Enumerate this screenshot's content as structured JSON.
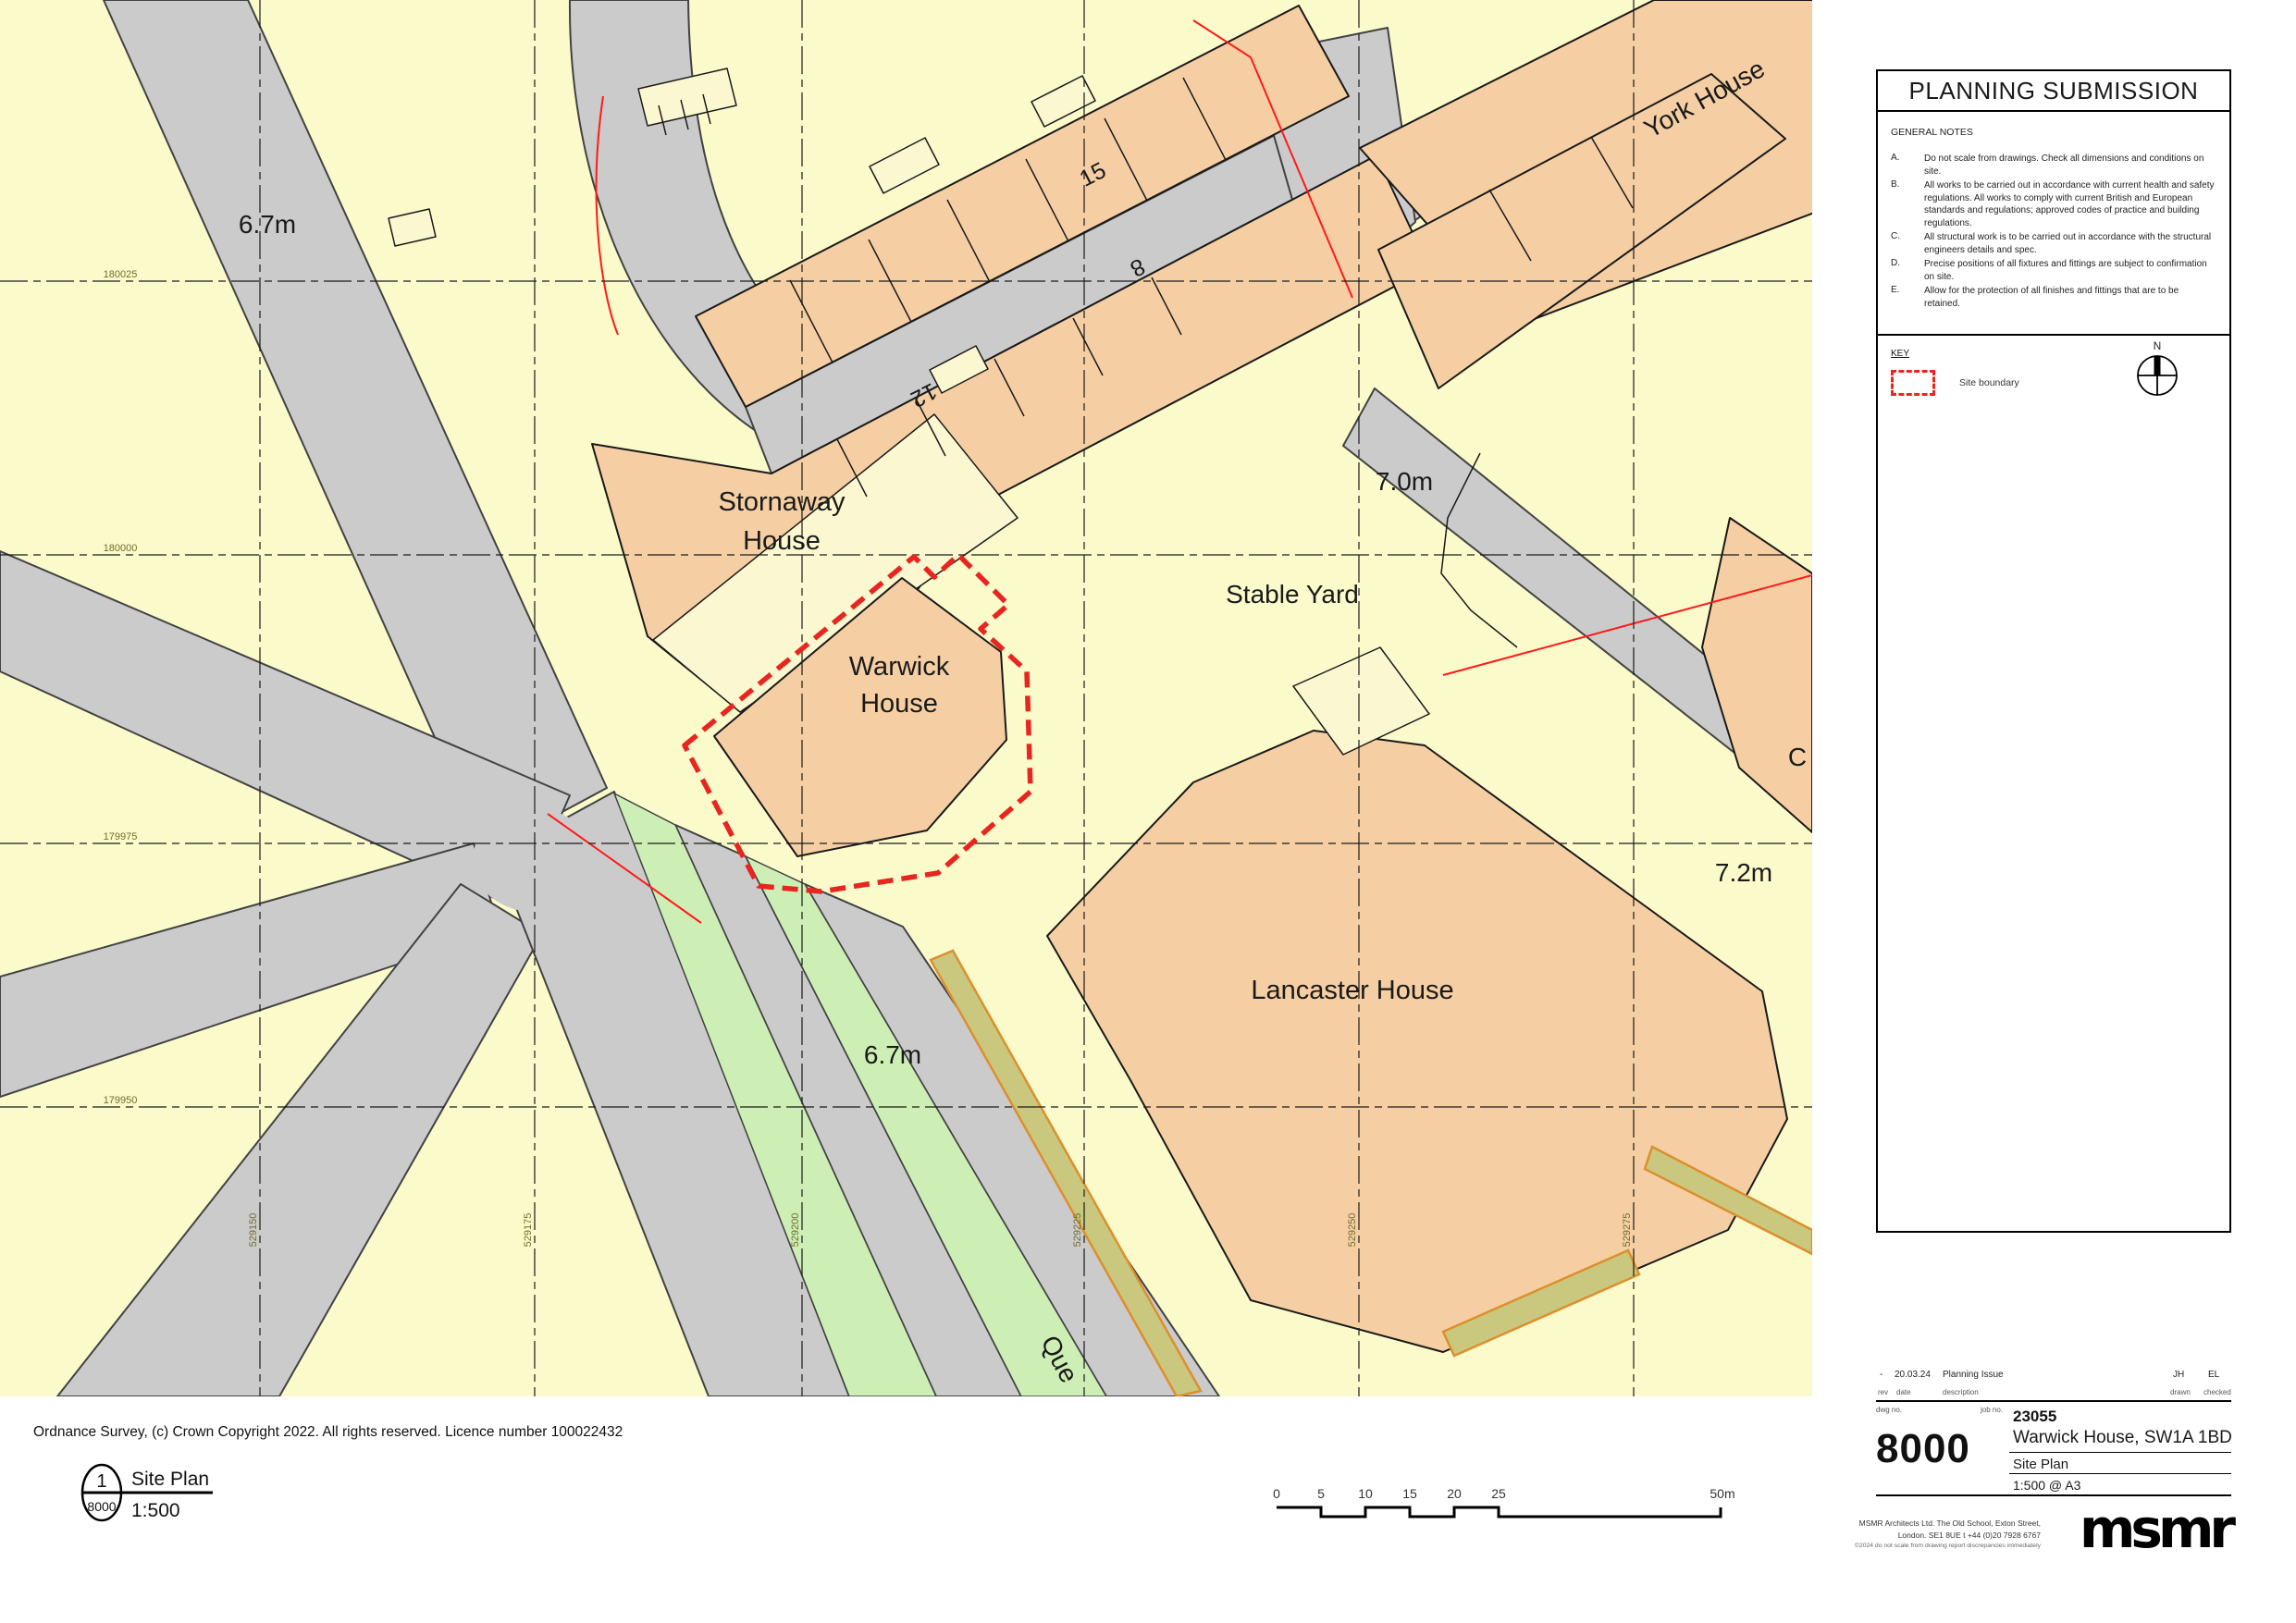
{
  "map": {
    "labels": {
      "road_67m": "6.7m",
      "york_house": "York House",
      "no15": "15",
      "no8": "8",
      "no12": "12",
      "stornaway_l1": "Stornaway",
      "stornaway_l2": "House",
      "warwick_l1": "Warwick",
      "warwick_l2": "House",
      "stable_yard": "Stable Yard",
      "level_70": "7.0m",
      "lancaster": "Lancaster House",
      "level_72": "7.2m",
      "green_67": "6.7m",
      "street_que": "Que",
      "partial_c": "C"
    },
    "grid": {
      "horizontal": [
        "180025",
        "180000",
        "179975",
        "179950"
      ],
      "vertical": [
        "529150",
        "529175",
        "529200",
        "529225",
        "529250",
        "529275"
      ]
    },
    "colors": {
      "background": "#fbfaca",
      "road": "#cbcbcb",
      "building": "#f5cfa3",
      "building_pale": "#fbf7d0",
      "green": "#cdefb5",
      "wall": "#c9c87e",
      "wall_edge": "#dd8f2e",
      "site_boundary": "#e8251f",
      "red_line": "#ff1a1a"
    },
    "copyright": "Ordnance Survey, (c) Crown Copyright 2022. All rights reserved. Licence number 100022432"
  },
  "drawing_ref": {
    "number": "1",
    "sheet": "8000",
    "title": "Site Plan",
    "scale": "1:500"
  },
  "scale_bar": {
    "ticks": [
      "0",
      "5",
      "10",
      "15",
      "20",
      "25",
      "50m"
    ]
  },
  "title_block": {
    "header": "PLANNING SUBMISSION",
    "general_notes_title": "GENERAL NOTES",
    "notes": [
      {
        "ref": "A.",
        "text": "Do not scale from drawings. Check all dimensions and conditions on site."
      },
      {
        "ref": "B.",
        "text": "All works to be carried out in accordance with current health and safety regulations.  All works to comply with current British and European standards and regulations; approved codes of practice and building regulations."
      },
      {
        "ref": "C.",
        "text": "All structural work is to be carried out in accordance with the structural engineers details and spec."
      },
      {
        "ref": "D.",
        "text": "Precise positions of all fixtures and fittings are subject to confirmation on site."
      },
      {
        "ref": "E.",
        "text": "Allow for the protection of all finishes and fittings that are to be retained."
      }
    ],
    "key": {
      "title": "KEY",
      "site_boundary": "Site boundary",
      "north": "N"
    },
    "revision": {
      "rev": "-",
      "date": "20.03.24",
      "description": "Planning Issue",
      "drawn": "JH",
      "checked": "EL",
      "labels": {
        "rev": "rev",
        "date": "date",
        "description": "description",
        "drawn": "drawn",
        "checked": "checked",
        "dwg_no": "dwg no.",
        "job_no": "job no."
      }
    },
    "project": {
      "dwg_number": "8000",
      "job_number": "23055",
      "name": "Warwick House, SW1A 1BD",
      "drawing_title": "Site Plan",
      "scale": "1:500 @ A3"
    },
    "firm": {
      "address_line1": "MSMR Architects Ltd.  The Old School, Exton Street,",
      "address_line2": "London.  SE1 8UE   t +44 (0)20 7928 6767",
      "disclaimer": "©2024   do not scale from drawing    report discrepancies immediately",
      "logo": "msmr"
    }
  }
}
